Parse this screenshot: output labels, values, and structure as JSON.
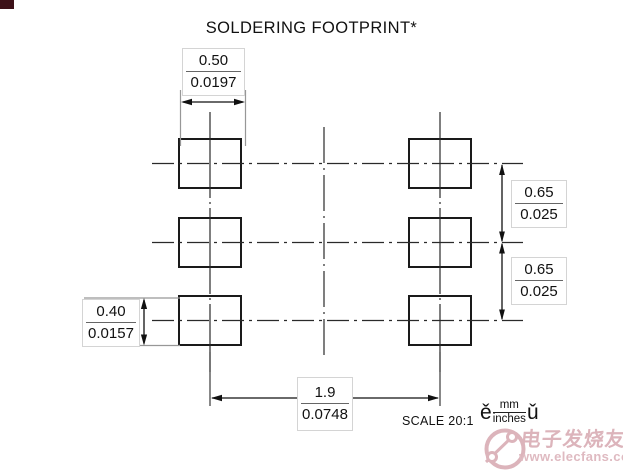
{
  "title": "SOLDERING FOOTPRINT*",
  "dims": {
    "pad_width": {
      "mm": "0.50",
      "inch": "0.0197"
    },
    "pitch_top": {
      "mm": "0.65",
      "inch": "0.025"
    },
    "pitch_bottom": {
      "mm": "0.65",
      "inch": "0.025"
    },
    "pad_height": {
      "mm": "0.40",
      "inch": "0.0157"
    },
    "span": {
      "mm": "1.9",
      "inch": "0.0748"
    }
  },
  "scale_label": "SCALE 20:1",
  "units_note": {
    "prefix": "ě",
    "numerator": "mm",
    "denominator": "inches",
    "suffix": "ǔ"
  },
  "watermark": {
    "cn": "电子发烧友",
    "url": "www.elecfans.com"
  },
  "colors": {
    "line": "#1a1a1a",
    "extension_line": "#979797",
    "box_border": "#d4d4d4",
    "watermark_pink": "#dcb4bb",
    "corner_artifact": "#3d1118"
  }
}
